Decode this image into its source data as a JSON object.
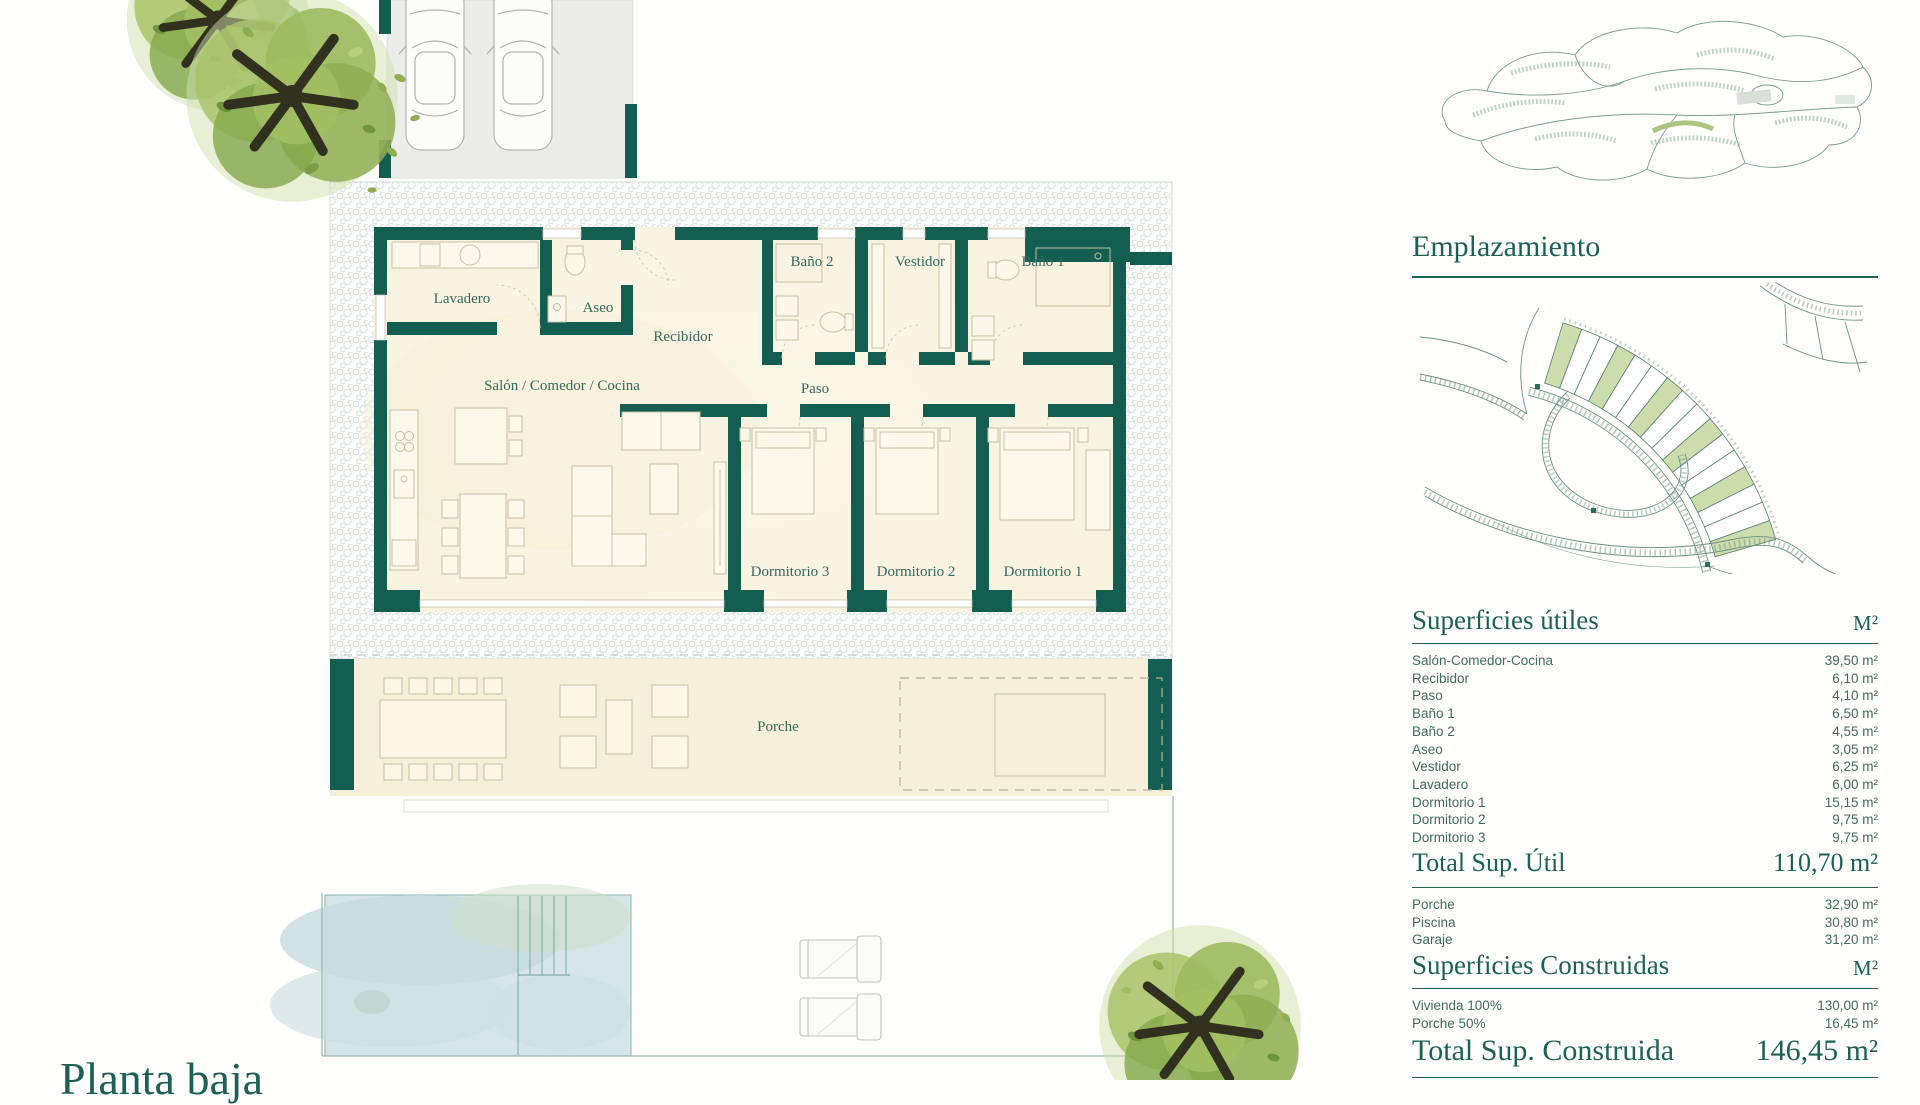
{
  "plan": {
    "caption": "Planta baja",
    "rooms": {
      "lavadero": "Lavadero",
      "aseo": "Aseo",
      "recibidor": "Recibidor",
      "bano2": "Baño 2",
      "vestidor": "Vestidor",
      "bano1": "Baño 1",
      "salon": "Salón / Comedor / Cocina",
      "paso": "Paso",
      "dorm3": "Dormitorio 3",
      "dorm2": "Dormitorio 2",
      "dorm1": "Dormitorio 1",
      "porche": "Porche"
    }
  },
  "sidebar": {
    "emplazamiento_title": "Emplazamiento",
    "utiles": {
      "title": "Superficies útiles",
      "unit": "M²",
      "rows": [
        {
          "label": "Salón-Comedor-Cocina",
          "value": "39,50 m²"
        },
        {
          "label": "Recibidor",
          "value": "6,10 m²"
        },
        {
          "label": "Paso",
          "value": "4,10 m²"
        },
        {
          "label": "Baño 1",
          "value": "6,50 m²"
        },
        {
          "label": "Baño 2",
          "value": "4,55 m²"
        },
        {
          "label": "Aseo",
          "value": "3,05 m²"
        },
        {
          "label": "Vestidor",
          "value": "6,25 m²"
        },
        {
          "label": "Lavadero",
          "value": "6,00 m²"
        },
        {
          "label": "Dormitorio 1",
          "value": "15,15 m²"
        },
        {
          "label": "Dormitorio 2",
          "value": "9,75 m²"
        },
        {
          "label": "Dormitorio 3",
          "value": "9,75 m²"
        }
      ]
    },
    "total_util": {
      "label": "Total Sup. Útil",
      "value": "110,70 m²"
    },
    "extras": [
      {
        "label": "Porche",
        "value": "32,90 m²"
      },
      {
        "label": "Piscina",
        "value": "30,80 m²"
      },
      {
        "label": "Garaje",
        "value": "31,20 m²"
      }
    ],
    "construidas": {
      "title": "Superficies Construidas",
      "unit": "M²",
      "rows": [
        {
          "label": "Vivienda 100%",
          "value": "130,00 m²"
        },
        {
          "label": "Porche 50%",
          "value": "16,45 m²"
        }
      ]
    },
    "total_construida": {
      "label": "Total Sup. Construida",
      "value": "146,45 m²"
    }
  },
  "colors": {
    "wall_teal": "#135e50",
    "heading_teal": "#1d6152",
    "floor_cream": "#f8f3e2",
    "pool_blue": "#d6e5e7",
    "plot_green": "#cbdcad"
  }
}
